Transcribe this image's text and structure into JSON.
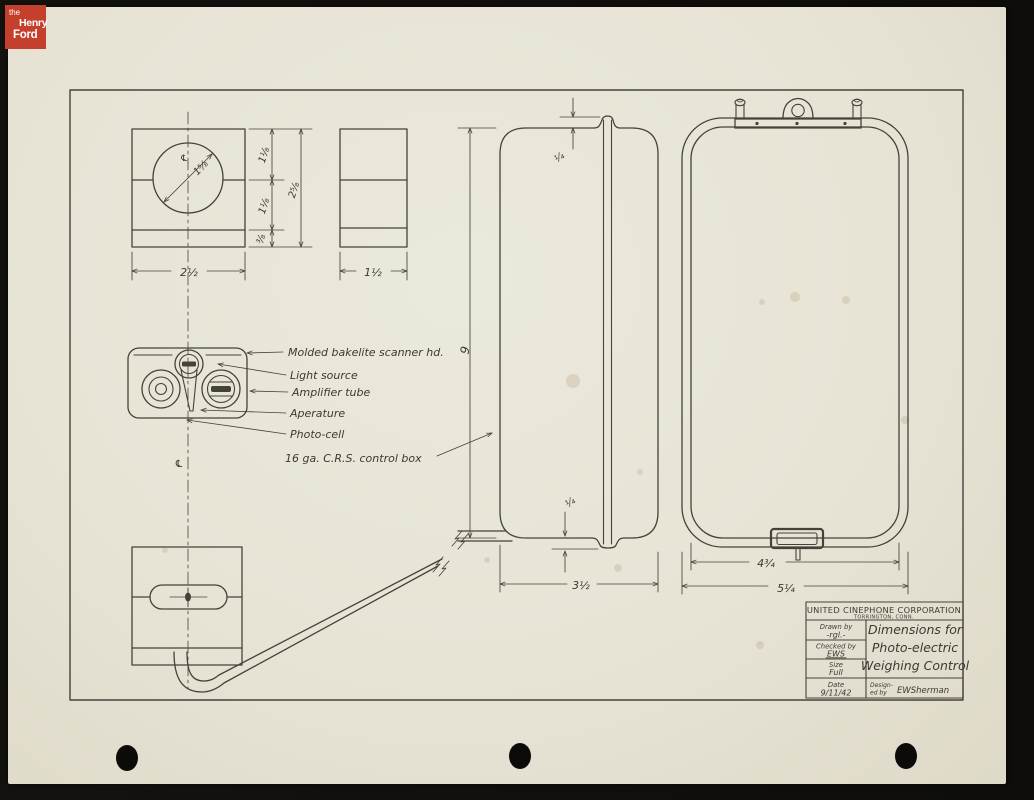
{
  "archive_logo": {
    "line1": "the",
    "line2": "Henry",
    "line3": "Ford"
  },
  "drawing": {
    "callouts": {
      "scanner_head": "Molded bakelite scanner hd.",
      "light_source": "Light source",
      "amplifier_tube": "Amplifier tube",
      "aperture": "Aperature",
      "photo_cell": "Photo-cell",
      "control_box": "16 ga. C.R.S. control box"
    },
    "dims": {
      "scanner_width": "2½",
      "scanner_depth": "1½",
      "upper_segment": "1⅛",
      "middle_segment": "1⅛",
      "lower_segment": "⅜",
      "scanner_height": "2⅝",
      "hole_diameter": "1⅝",
      "box_height": "9",
      "flange_top": "¼",
      "flange_bottom": "¼",
      "box_depth": "3½",
      "box_inner_width": "4¾",
      "box_outer_width": "5¼",
      "centerline": "℄"
    },
    "title_block": {
      "company": "UNITED CINEPHONE CORPORATION",
      "location": "TORRINGTON, CONN.",
      "drawn_by_label": "Drawn by",
      "drawn_by": "-rgl.-",
      "checked_by_label": "Checked by",
      "checked_by": "EWS",
      "size_label": "Size",
      "size": "Full",
      "date_label": "Date",
      "date": "9/11/42",
      "designed_by_label_1": "Design-",
      "designed_by_label_2": "ed by",
      "designed_by": "EWSherman",
      "title_line1": "Dimensions for",
      "title_line2": "Photo-electric",
      "title_line3": "Weighing Control"
    }
  },
  "colors": {
    "paper": "#e7e4d6",
    "ink": "#45423a",
    "logo_red": "#c5402c",
    "scan_bg": "#12100d"
  }
}
